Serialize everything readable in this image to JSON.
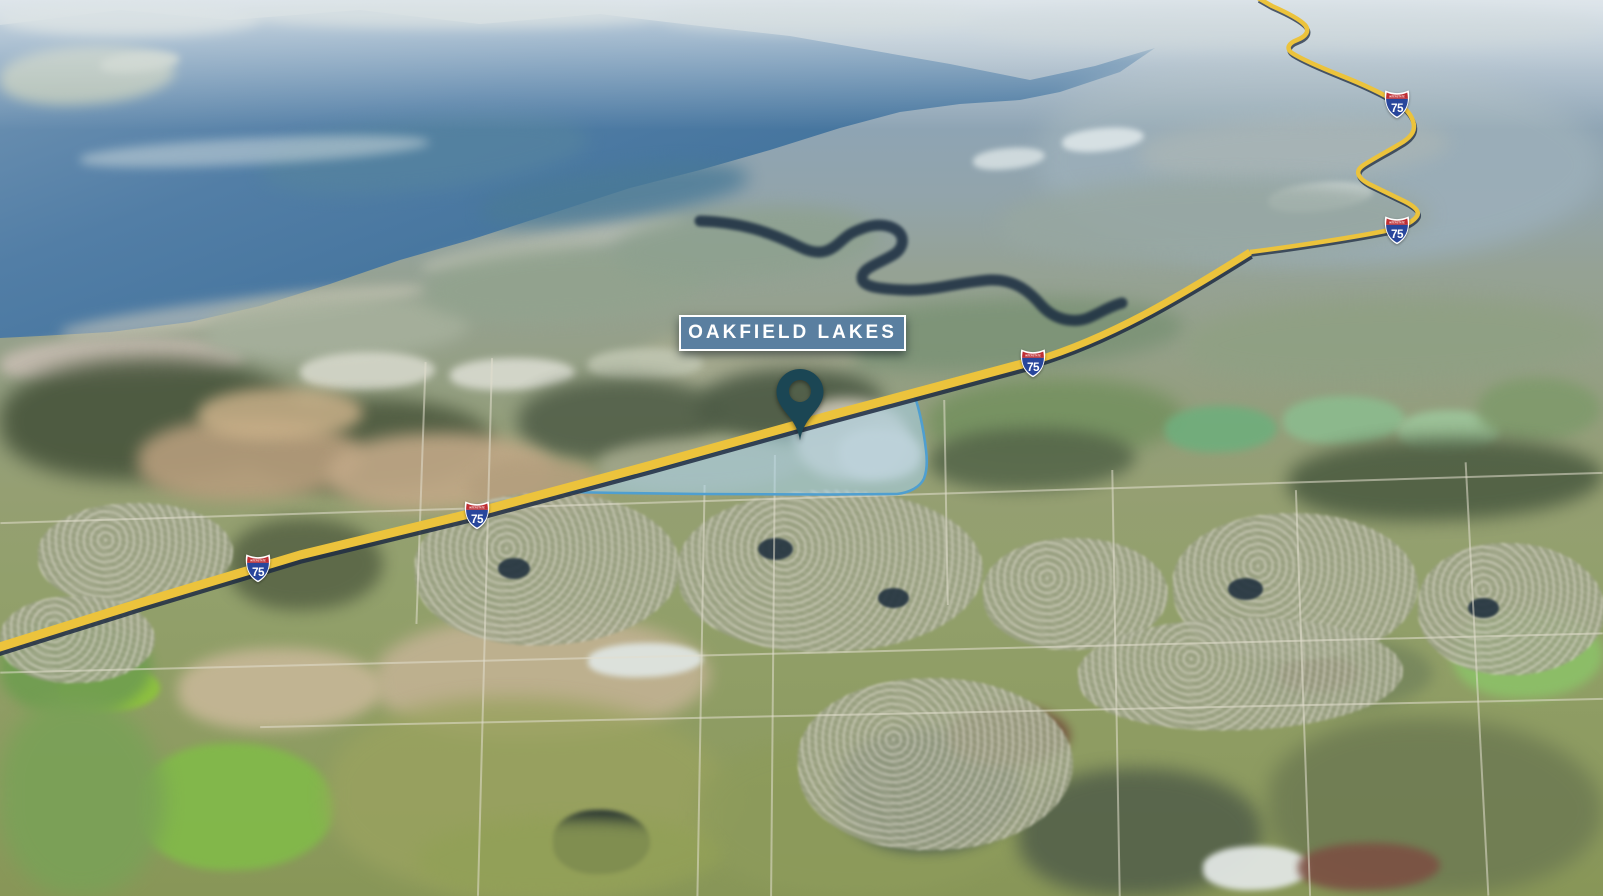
{
  "map": {
    "type": "aerial-3d-satellite-view",
    "label": "OAKFIELD LAKES",
    "highway": {
      "name": "Interstate 75",
      "shield_number": "75",
      "shield_band_text": "INTERSTATE",
      "route_color": "#ecc33c",
      "route_shadow_color": "#1f2c42",
      "shield_blue": "#28469c",
      "shield_red": "#bf2e33",
      "shield_border": "#ffffff",
      "shields": [
        {
          "label": "75",
          "x": 1397,
          "y": 103
        },
        {
          "label": "75",
          "x": 1397,
          "y": 229
        },
        {
          "label": "75",
          "x": 1033,
          "y": 362
        },
        {
          "label": "75",
          "x": 477,
          "y": 514
        },
        {
          "label": "75",
          "x": 258,
          "y": 567
        }
      ]
    },
    "property": {
      "fill": "rgba(167,211,237,0.55)",
      "stroke": "#4f9fd0"
    },
    "pin": {
      "color": "#1b4654"
    },
    "label_box": {
      "bg": "#5a7fa0",
      "border_color": "#ffffff",
      "text_color": "#ffffff"
    }
  }
}
